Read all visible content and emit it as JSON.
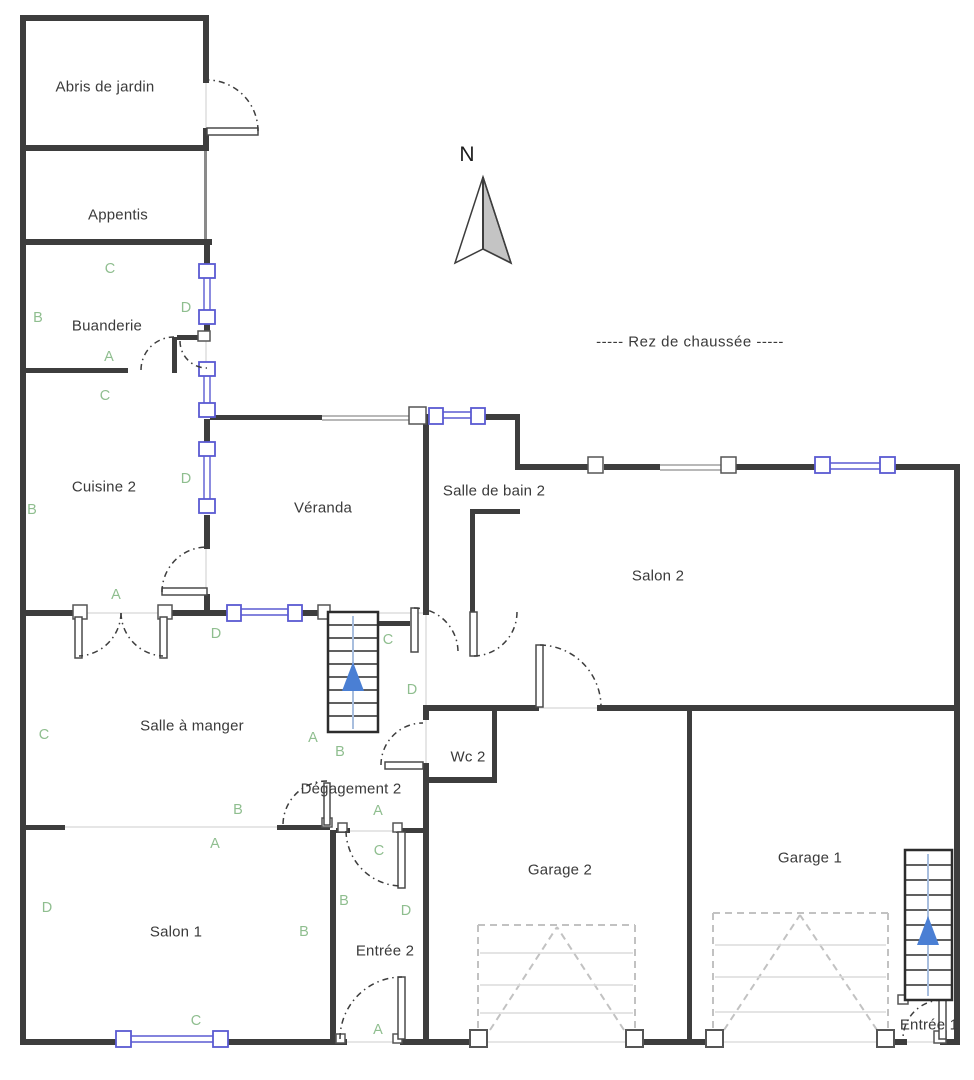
{
  "floor_title": "Rez de chaussée",
  "floor_title_display": "-----   Rez de chaussée   -----",
  "north_label": "N",
  "rooms": {
    "abris_de_jardin": "Abris de jardin",
    "appentis": "Appentis",
    "buanderie": "Buanderie",
    "cuisine_2": "Cuisine 2",
    "veranda": "Véranda",
    "salle_de_bain_2": "Salle de bain 2",
    "salon_2": "Salon 2",
    "salle_a_manger": "Salle à manger",
    "wc_2": "Wc 2",
    "degagement_2": "Dégagement 2",
    "salon_1": "Salon 1",
    "entree_2": "Entrée 2",
    "garage_2": "Garage 2",
    "garage_1": "Garage 1",
    "entree_1": "Entrée 1"
  },
  "letters": [
    "C",
    "B",
    "D",
    "A",
    "C",
    "B",
    "D",
    "A",
    "D",
    "C",
    "D",
    "C",
    "A",
    "B",
    "B",
    "A",
    "A",
    "C",
    "B",
    "D",
    "B",
    "D",
    "C",
    "A"
  ],
  "colors": {
    "wall": "#3d3d3d",
    "window_blue": "#5a5ad2",
    "stair_arrow_blue": "#4a7fd4",
    "stair_line_blue": "#a8bede",
    "label_green": "#8fbe8f",
    "garage_dash": "#c2c2c2",
    "north_fill": "#c4c4c4",
    "text": "#3a3a3a"
  }
}
